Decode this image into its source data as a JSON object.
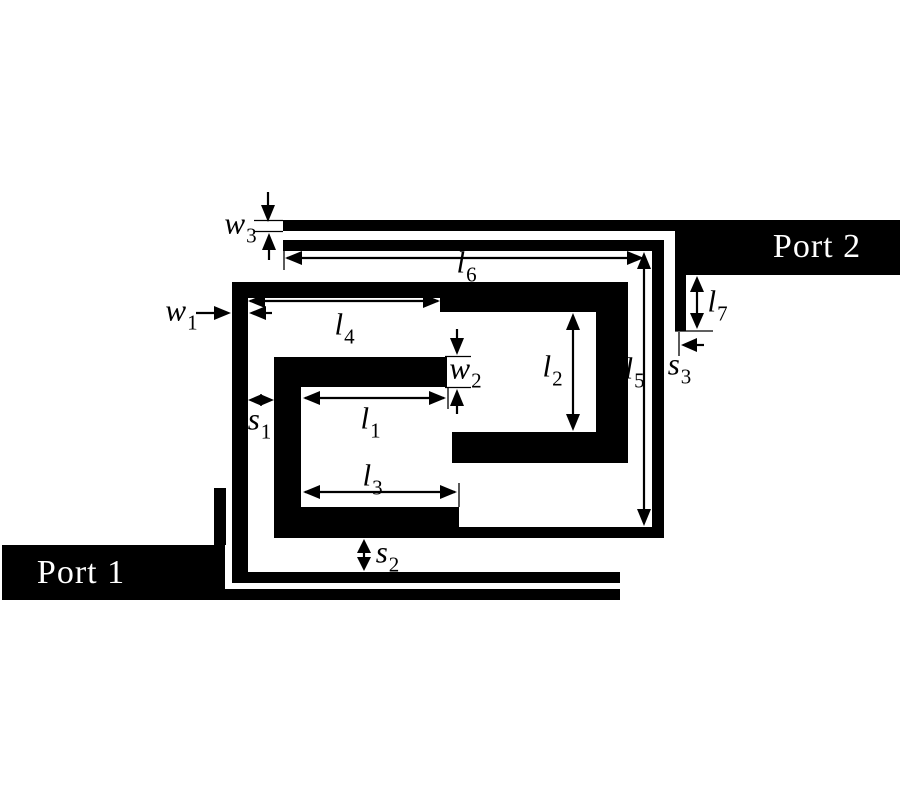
{
  "figure": {
    "type": "microstrip-filter-layout-diagram",
    "colors": {
      "conductor": "#000000",
      "background": "#ffffff",
      "dimension_lines": "#000000",
      "port_text": "#ffffff"
    }
  },
  "ports": {
    "port1": {
      "label": "Port 1"
    },
    "port2": {
      "label": "Port 2"
    }
  },
  "dims": {
    "w1": {
      "base": "w",
      "sub": "1"
    },
    "w2": {
      "base": "w",
      "sub": "2"
    },
    "w3": {
      "base": "w",
      "sub": "3"
    },
    "l1": {
      "base": "l",
      "sub": "1"
    },
    "l2": {
      "base": "l",
      "sub": "2"
    },
    "l3": {
      "base": "l",
      "sub": "3"
    },
    "l4": {
      "base": "l",
      "sub": "4"
    },
    "l5": {
      "base": "l",
      "sub": "5"
    },
    "l6": {
      "base": "l",
      "sub": "6"
    },
    "l7": {
      "base": "l",
      "sub": "7"
    },
    "s1": {
      "base": "s",
      "sub": "1"
    },
    "s2": {
      "base": "s",
      "sub": "2"
    },
    "s3": {
      "base": "s",
      "sub": "3"
    }
  }
}
